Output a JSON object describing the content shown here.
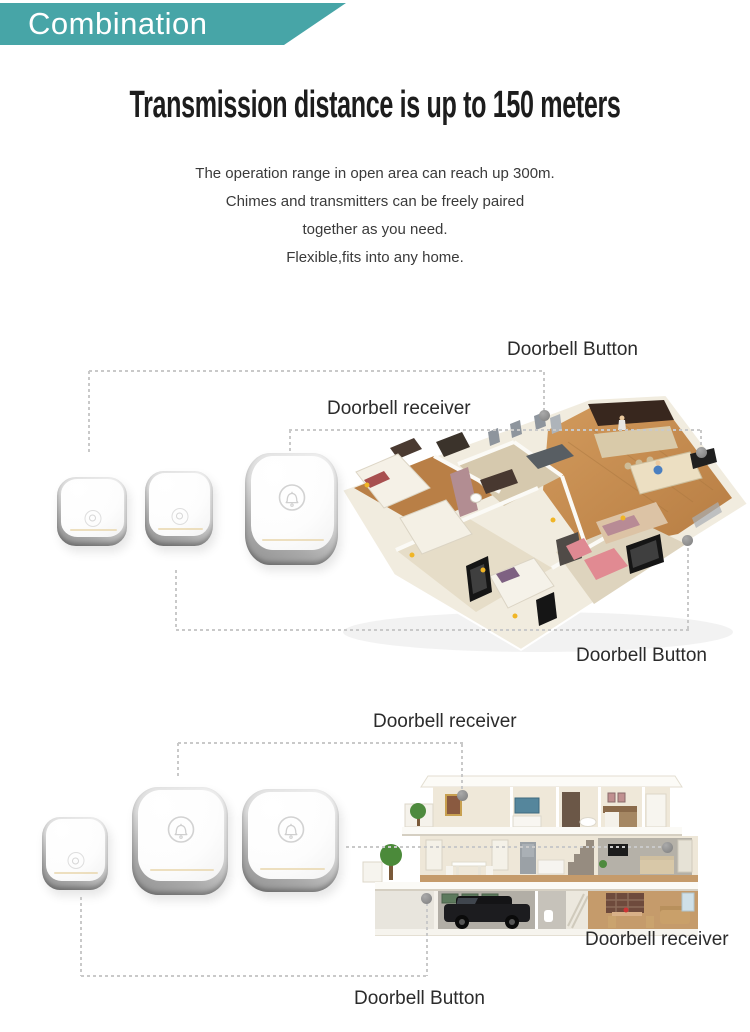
{
  "banner": {
    "label": "Combination"
  },
  "headline": {
    "text": "Transmission distance is up to 150 meters"
  },
  "description": {
    "line1": "The operation range in open area can reach up 300m.",
    "line2": "Chimes and transmitters can be freely paired",
    "line3": "together as you need.",
    "line4": "Flexible,fits into any home."
  },
  "diagram_apartment": {
    "doorbell_button_top_label": "Doorbell Button",
    "doorbell_receiver_label": "Doorbell receiver",
    "doorbell_button_bottom_label": "Doorbell Button",
    "devices": [
      "doorbell-button",
      "doorbell-button",
      "doorbell-receiver"
    ]
  },
  "diagram_house": {
    "doorbell_receiver_top_label": "Doorbell receiver",
    "doorbell_receiver_right_label": "Doorbell receiver",
    "doorbell_button_bottom_label": "Doorbell Button",
    "devices": [
      "doorbell-button",
      "doorbell-receiver",
      "doorbell-receiver"
    ]
  },
  "icons": {
    "device_face": "bell-icon"
  },
  "colors": {
    "banner_teal": "#47a5a7",
    "banner_text": "#ffffff",
    "headline_text": "#1d1d1d",
    "body_text": "#3a3a3a",
    "label_text": "#2b2b2b",
    "connector_line": "#c9c9c9",
    "connector_dot": "#8d8d8d"
  }
}
